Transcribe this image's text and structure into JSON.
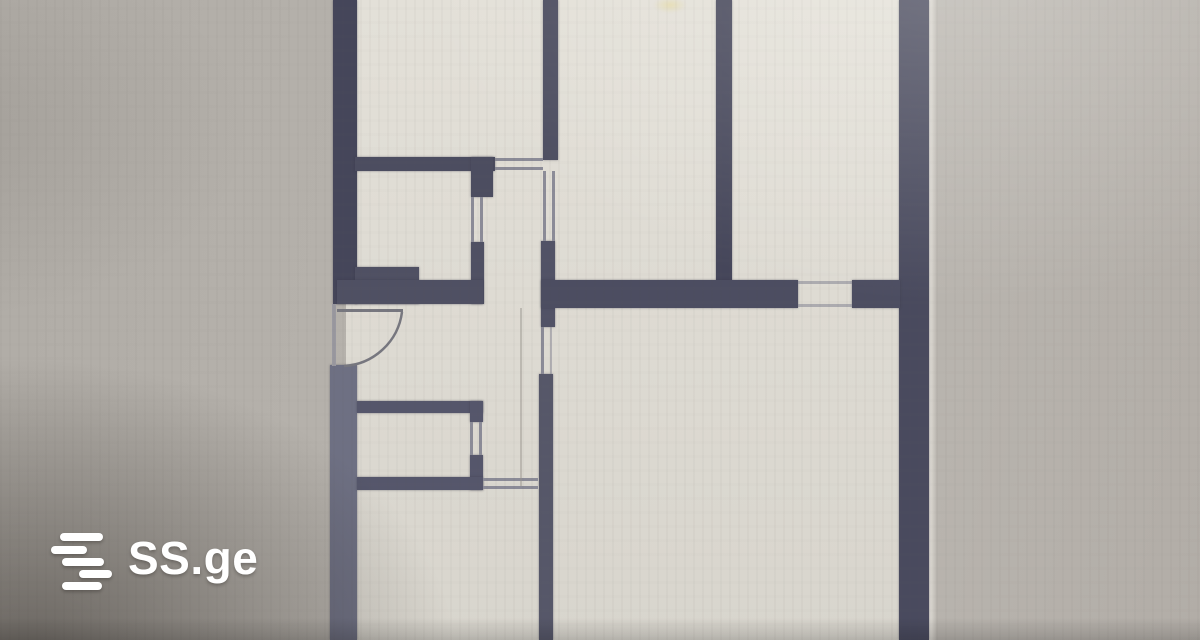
{
  "image": {
    "description": "photo of a printed apartment floor plan with SS.ge watermark"
  },
  "watermark": {
    "brand_text": "SS.ge",
    "icon": "ss-logo-stacked-lines-icon",
    "text_color": "#ffffff",
    "bars": [
      {
        "x": 60,
        "y": 533,
        "w": 43,
        "h": 8
      },
      {
        "x": 51,
        "y": 546,
        "w": 36,
        "h": 8
      },
      {
        "x": 62,
        "y": 558,
        "w": 42,
        "h": 8
      },
      {
        "x": 79,
        "y": 570,
        "w": 33,
        "h": 8
      },
      {
        "x": 62,
        "y": 582,
        "w": 40,
        "h": 8
      }
    ]
  },
  "palette": {
    "wall_dark": "#4a4b5f",
    "wall_light": "#6e7083",
    "paper": "#dedbd3",
    "background_gray": "#b3afa9",
    "background_shadow": "#6e6962",
    "thin_line": "#8b8b97"
  },
  "floor_plan": {
    "type": "apartment-2d-plan",
    "units": "px",
    "walls": [
      {
        "x": 333,
        "y": 0,
        "w": 24,
        "h": 304,
        "c": "#45465a"
      },
      {
        "x": 330,
        "y": 365,
        "w": 27,
        "h": 275,
        "c": "#6e7083"
      },
      {
        "x": 899,
        "y": 0,
        "w": 30,
        "h": 640,
        "c": "#494a5e"
      },
      {
        "x": 543,
        "y": 0,
        "w": 15,
        "h": 160,
        "c": "#4c4d60"
      },
      {
        "x": 541,
        "y": 241,
        "w": 14,
        "h": 86,
        "c": "#515266"
      },
      {
        "x": 539,
        "y": 374,
        "w": 14,
        "h": 266,
        "c": "#565769"
      },
      {
        "x": 716,
        "y": 0,
        "w": 16,
        "h": 283,
        "c": "#45465a"
      },
      {
        "x": 355,
        "y": 157,
        "w": 140,
        "h": 14,
        "c": "#4c4d60"
      },
      {
        "x": 471,
        "y": 157,
        "w": 22,
        "h": 40,
        "c": "#4c4d60"
      },
      {
        "x": 471,
        "y": 242,
        "w": 13,
        "h": 62,
        "c": "#4f5063"
      },
      {
        "x": 355,
        "y": 267,
        "w": 64,
        "h": 37,
        "c": "#4f5063"
      },
      {
        "x": 337,
        "y": 280,
        "w": 146,
        "h": 24,
        "c": "#4f5063"
      },
      {
        "x": 541,
        "y": 280,
        "w": 257,
        "h": 28,
        "c": "#4c4d61"
      },
      {
        "x": 852,
        "y": 280,
        "w": 48,
        "h": 28,
        "c": "#4c4d61"
      },
      {
        "x": 357,
        "y": 401,
        "w": 126,
        "h": 12,
        "c": "#55566b"
      },
      {
        "x": 470,
        "y": 401,
        "w": 13,
        "h": 21,
        "c": "#55566b"
      },
      {
        "x": 470,
        "y": 455,
        "w": 13,
        "h": 35,
        "c": "#55566b"
      },
      {
        "x": 357,
        "y": 477,
        "w": 126,
        "h": 13,
        "c": "#55566b"
      }
    ],
    "opening_lines": [
      {
        "x": 495,
        "y": 158,
        "w": 48,
        "h": 3
      },
      {
        "x": 495,
        "y": 167,
        "w": 48,
        "h": 3
      },
      {
        "x": 471,
        "y": 197,
        "w": 3,
        "h": 45
      },
      {
        "x": 480,
        "y": 197,
        "w": 3,
        "h": 45
      },
      {
        "x": 543,
        "y": 171,
        "w": 3,
        "h": 70
      },
      {
        "x": 552,
        "y": 171,
        "w": 3,
        "h": 70
      },
      {
        "x": 541,
        "y": 327,
        "w": 3,
        "h": 47
      },
      {
        "x": 550,
        "y": 327,
        "w": 2,
        "h": 47,
        "c": "rgba(139,139,151,0.55)"
      },
      {
        "x": 483,
        "y": 478,
        "w": 55,
        "h": 3
      },
      {
        "x": 483,
        "y": 486,
        "w": 55,
        "h": 3
      },
      {
        "x": 798,
        "y": 281,
        "w": 54,
        "h": 3,
        "c": "rgba(139,139,151,0.6)"
      },
      {
        "x": 798,
        "y": 304,
        "w": 54,
        "h": 3,
        "c": "rgba(139,139,151,0.6)"
      },
      {
        "x": 470,
        "y": 422,
        "w": 3,
        "h": 33
      },
      {
        "x": 479,
        "y": 422,
        "w": 3,
        "h": 33
      },
      {
        "x": 332,
        "y": 304,
        "w": 4,
        "h": 62,
        "c": "#9a99a0"
      },
      {
        "x": 337,
        "y": 309,
        "w": 66,
        "h": 3,
        "c": "#77777f"
      },
      {
        "x": 520,
        "y": 308,
        "w": 2,
        "h": 178,
        "c": "rgba(148,145,138,0.45)"
      }
    ],
    "door": {
      "arc_path": "M 402 312 A 62 62 0 0 1 344 366",
      "arc_color": "#77777f"
    }
  }
}
